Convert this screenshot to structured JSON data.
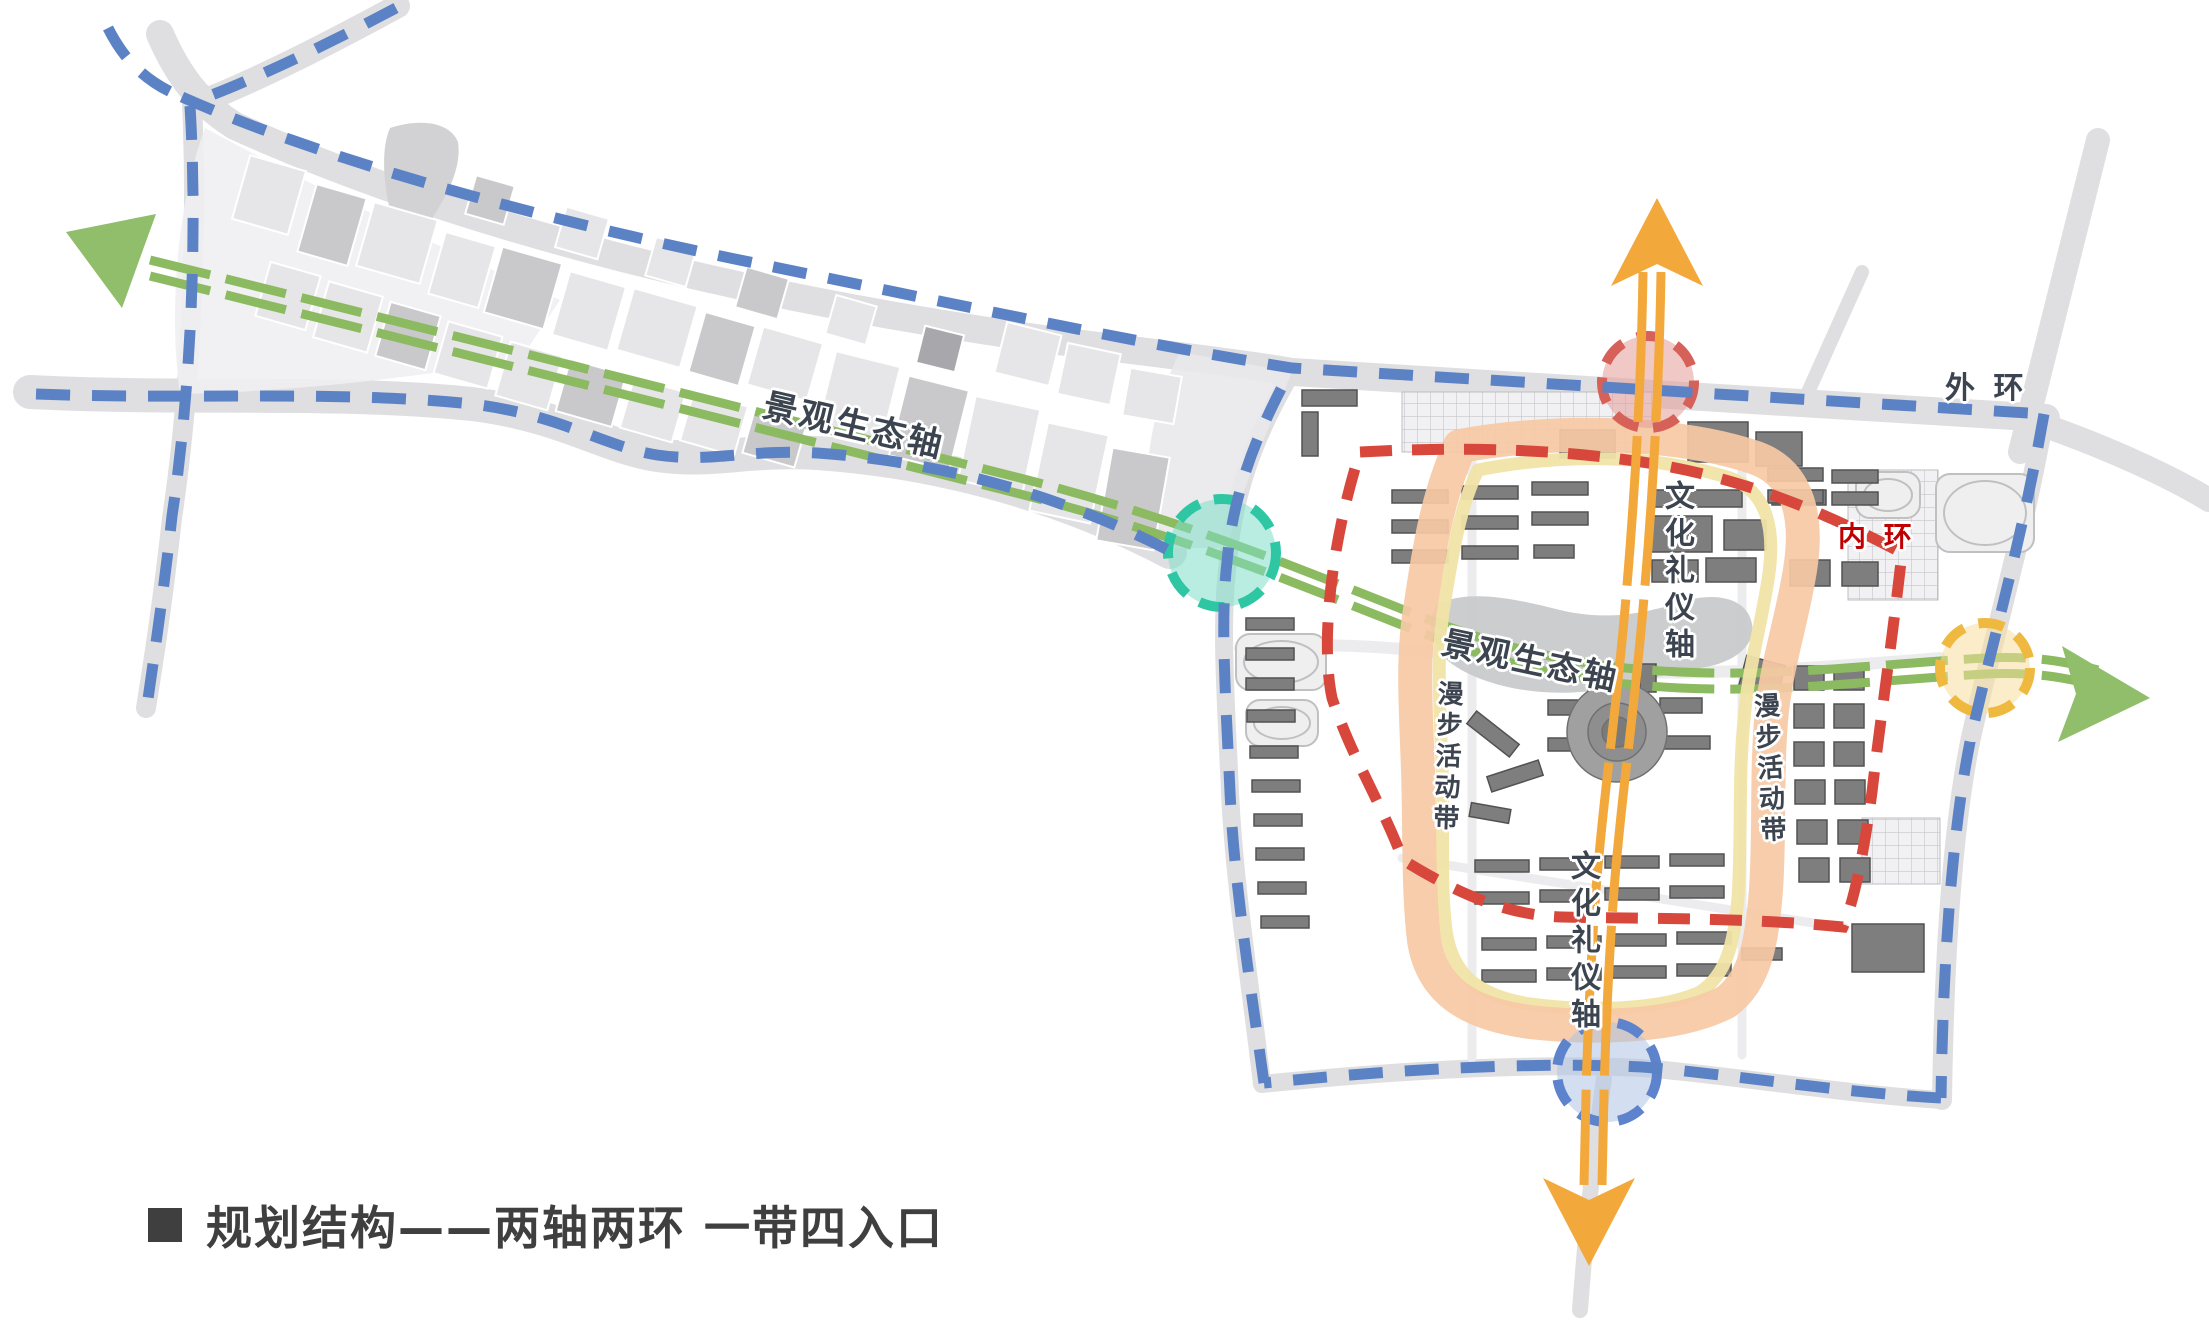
{
  "title": {
    "text": "规划结构——两轴两环  一带四入口"
  },
  "labels": {
    "outer_ring": "外 环",
    "inner_ring": "内 环",
    "eco_axis_west": "景观生态轴",
    "eco_axis_center": "景观生态轴",
    "culture_axis_top": "文化礼仪轴",
    "culture_axis_bottom": "文化礼仪轴",
    "stroll_belt_left": "漫步活动带",
    "stroll_belt_right": "漫步活动带"
  },
  "colors": {
    "road": "#DFDFE1",
    "road_light": "#ECECEE",
    "outer_blue": "#5C82C6",
    "inner_red": "#D7473C",
    "green": "#8BBA60",
    "green_arrow": "#90BE6B",
    "orange": "#F3A83C",
    "peach": "#F6C9A5",
    "yellow_band": "#F1E4A6",
    "teal_ring": "#2FC6A4",
    "teal_fill": "#7FDFC8",
    "red_ring": "#D66158",
    "red_fill": "#E39B97",
    "blue_ring": "#5C83CB",
    "blue_fill": "#AFC4E6",
    "gold_ring": "#EFB93F",
    "gold_fill": "#F7DF9C",
    "building": "#7E7E7E",
    "building_stroke": "#525252",
    "parcel_light": "#E6E6E8",
    "parcel_med": "#C9C9CC",
    "parcel_dark": "#A8A8AC",
    "blob": "#D2D2D4",
    "pond": "#C8CACB",
    "text_dark": "#3C4450",
    "text_red": "#C00000",
    "title_color": "#3F3F3F"
  },
  "map": {
    "roads": [
      {
        "d": "M 160,34 C 178,76 200,104 235,126 C 470,232 760,300 1050,340 C 1180,356 1260,366 1292,372 L 2046,418",
        "w": 28
      },
      {
        "d": "M 398,6 C 335,40 266,76 206,100",
        "w": 24
      },
      {
        "d": "M 2020,452 L 2098,140",
        "w": 24
      },
      {
        "d": "M 2040,424 C 2120,452 2180,482 2209,500",
        "w": 24
      },
      {
        "d": "M 192,102 C 198,240 190,398 172,518 C 163,600 154,658 146,708",
        "w": 20
      },
      {
        "d": "M 30,392 C 190,400 335,390 472,404 C 562,415 602,446 657,455 C 712,463 747,449 817,453 C 962,463 1082,506 1170,552",
        "w": 34
      },
      {
        "d": "M 2044,418 C 2022,542 1992,642 1970,742 C 1952,832 1944,962 1942,1100",
        "w": 20
      },
      {
        "d": "M 1942,1100 C 1842,1094 1722,1074 1642,1068 C 1522,1062 1382,1072 1262,1084",
        "w": 18
      },
      {
        "d": "M 1292,372 C 1264,420 1234,482 1228,562 C 1220,622 1226,702 1230,792 C 1234,882 1250,982 1262,1084",
        "w": 18
      },
      {
        "d": "M 1604,1078 C 1594,1150 1586,1230 1580,1310",
        "w": 16
      },
      {
        "d": "M 1800,410 L 1862,272",
        "w": 14
      },
      {
        "d": "M 1240,648 C 1380,638 1470,658 1560,668 C 1660,678 1800,670 1940,658",
        "w": 12,
        "light": 1
      },
      {
        "d": "M 1472,462 L 1472,1058",
        "w": 9,
        "light": 1
      },
      {
        "d": "M 1742,470 L 1742,1055",
        "w": 9,
        "light": 1
      },
      {
        "d": "M 1402,858 L 1845,928",
        "w": 9,
        "light": 1
      }
    ],
    "blobs": [
      {
        "d": "M 205,128 C 320,190 440,248 560,300 L 520,360 C 400,380 280,392 180,394 C 168,310 178,200 205,128 Z",
        "fill": "#F0F0F2",
        "o": 0.9
      },
      {
        "d": "M 390,128 C 420,118 450,122 458,142 C 462,170 445,198 430,222 C 418,240 398,236 392,218 C 384,190 380,150 390,128 Z",
        "fill": "#D2D2D4",
        "o": 1
      },
      {
        "d": "M 1180,352 L 1292,372 C 1268,430 1240,490 1228,548 L 1150,548 C 1140,480 1150,410 1180,352 Z",
        "fill": "#E9E9EB",
        "o": 0.9
      },
      {
        "d": "M 1438,604 C 1470,588 1520,600 1560,610 C 1610,622 1650,612 1688,600 C 1720,592 1748,600 1752,624 C 1756,648 1730,664 1700,668 C 1660,674 1620,690 1580,692 C 1530,696 1480,684 1452,664 C 1432,650 1424,618 1438,604 Z",
        "fill": "#C8CACB",
        "o": 0.95
      }
    ],
    "parcels": [
      [
        240,
        162,
        58,
        66,
        16,
        0
      ],
      [
        306,
        190,
        52,
        70,
        16,
        1
      ],
      [
        364,
        210,
        66,
        66,
        16,
        0
      ],
      [
        436,
        238,
        52,
        64,
        16,
        0
      ],
      [
        492,
        254,
        62,
        68,
        16,
        1
      ],
      [
        560,
        278,
        58,
        66,
        16,
        0
      ],
      [
        624,
        296,
        66,
        64,
        16,
        0
      ],
      [
        696,
        318,
        52,
        62,
        16,
        1
      ],
      [
        754,
        334,
        62,
        60,
        16,
        0
      ],
      [
        262,
        268,
        52,
        56,
        16,
        0
      ],
      [
        320,
        288,
        56,
        58,
        16,
        0
      ],
      [
        382,
        308,
        52,
        56,
        16,
        1
      ],
      [
        440,
        328,
        56,
        54,
        16,
        0
      ],
      [
        502,
        348,
        54,
        56,
        16,
        0
      ],
      [
        562,
        366,
        58,
        54,
        16,
        1
      ],
      [
        626,
        384,
        54,
        52,
        16,
        0
      ],
      [
        686,
        398,
        56,
        51,
        16,
        0
      ],
      [
        748,
        413,
        54,
        48,
        16,
        1
      ],
      [
        826,
        358,
        66,
        76,
        14,
        0
      ],
      [
        898,
        382,
        62,
        82,
        14,
        1
      ],
      [
        966,
        402,
        66,
        86,
        12,
        0
      ],
      [
        1038,
        428,
        62,
        90,
        12,
        0
      ],
      [
        1104,
        452,
        58,
        94,
        10,
        1
      ],
      [
        1000,
        328,
        56,
        52,
        14,
        0
      ],
      [
        1062,
        348,
        54,
        52,
        12,
        0
      ],
      [
        1126,
        372,
        52,
        48,
        10,
        0
      ],
      [
        470,
        180,
        40,
        40,
        16,
        1
      ],
      [
        560,
        212,
        44,
        42,
        16,
        0
      ],
      [
        650,
        242,
        42,
        40,
        16,
        0
      ],
      [
        740,
        272,
        44,
        42,
        16,
        1
      ],
      [
        830,
        300,
        42,
        40,
        16,
        0
      ],
      [
        920,
        330,
        40,
        38,
        14,
        2
      ]
    ],
    "grids": [
      [
        1402,
        392,
        252,
        60
      ],
      [
        1848,
        470,
        90,
        130
      ],
      [
        1862,
        818,
        78,
        66
      ]
    ],
    "fields": [
      [
        1856,
        472,
        64,
        46
      ],
      [
        1936,
        474,
        98,
        78
      ],
      [
        1236,
        634,
        90,
        56
      ],
      [
        1246,
        700,
        72,
        46
      ]
    ],
    "buildings": [
      [
        1392,
        490,
        56,
        13
      ],
      [
        1392,
        520,
        56,
        13
      ],
      [
        1392,
        550,
        56,
        13
      ],
      [
        1462,
        486,
        56,
        13
      ],
      [
        1462,
        516,
        56,
        13
      ],
      [
        1462,
        546,
        56,
        13
      ],
      [
        1532,
        482,
        56,
        13
      ],
      [
        1532,
        512,
        56,
        13
      ],
      [
        1534,
        545,
        40,
        13
      ],
      [
        1650,
        490,
        92,
        17
      ],
      [
        1650,
        516,
        62,
        36
      ],
      [
        1724,
        520,
        42,
        30
      ],
      [
        1772,
        490,
        54,
        15
      ],
      [
        1652,
        560,
        46,
        22
      ],
      [
        1706,
        558,
        50,
        24
      ],
      [
        1560,
        430,
        55,
        28
      ],
      [
        1688,
        422,
        60,
        40
      ],
      [
        1756,
        432,
        46,
        34
      ],
      [
        1768,
        468,
        55,
        13
      ],
      [
        1768,
        490,
        55,
        13
      ],
      [
        1832,
        470,
        46,
        13
      ],
      [
        1832,
        492,
        46,
        13
      ],
      [
        1302,
        390,
        55,
        16
      ],
      [
        1302,
        412,
        16,
        44
      ],
      [
        1246,
        618,
        48,
        12
      ],
      [
        1246,
        648,
        48,
        12
      ],
      [
        1246,
        678,
        48,
        12
      ],
      [
        1247,
        710,
        48,
        12
      ],
      [
        1250,
        746,
        48,
        12
      ],
      [
        1252,
        780,
        48,
        12
      ],
      [
        1254,
        814,
        48,
        12
      ],
      [
        1256,
        848,
        48,
        12
      ],
      [
        1258,
        882,
        48,
        12
      ],
      [
        1261,
        916,
        48,
        12
      ],
      [
        1466,
        726,
        54,
        16,
        38
      ],
      [
        1488,
        768,
        54,
        16,
        -18
      ],
      [
        1470,
        806,
        40,
        14,
        10
      ],
      [
        1475,
        860,
        54,
        12
      ],
      [
        1475,
        892,
        54,
        12
      ],
      [
        1540,
        858,
        54,
        12
      ],
      [
        1540,
        890,
        54,
        12
      ],
      [
        1605,
        856,
        54,
        12
      ],
      [
        1605,
        888,
        54,
        12
      ],
      [
        1670,
        854,
        54,
        12
      ],
      [
        1670,
        886,
        54,
        12
      ],
      [
        1482,
        938,
        54,
        12
      ],
      [
        1482,
        970,
        54,
        12
      ],
      [
        1547,
        936,
        54,
        12
      ],
      [
        1547,
        968,
        54,
        12
      ],
      [
        1612,
        934,
        54,
        12
      ],
      [
        1612,
        966,
        54,
        12
      ],
      [
        1677,
        932,
        54,
        12
      ],
      [
        1677,
        964,
        54,
        12
      ],
      [
        1742,
        948,
        40,
        12
      ],
      [
        1794,
        666,
        30,
        24
      ],
      [
        1834,
        666,
        30,
        24
      ],
      [
        1794,
        704,
        30,
        24
      ],
      [
        1834,
        704,
        30,
        24
      ],
      [
        1794,
        742,
        30,
        24
      ],
      [
        1834,
        742,
        30,
        24
      ],
      [
        1795,
        780,
        30,
        24
      ],
      [
        1835,
        780,
        30,
        24
      ],
      [
        1797,
        820,
        30,
        24
      ],
      [
        1838,
        820,
        30,
        24
      ],
      [
        1799,
        858,
        30,
        24
      ],
      [
        1840,
        858,
        30,
        24
      ],
      [
        1852,
        924,
        72,
        48
      ],
      [
        1548,
        700,
        38,
        15
      ],
      [
        1548,
        738,
        44,
        13
      ],
      [
        1660,
        698,
        42,
        15
      ],
      [
        1664,
        736,
        46,
        13
      ],
      [
        1588,
        666,
        16,
        28
      ],
      [
        1640,
        664,
        16,
        28
      ],
      [
        1742,
        660,
        40,
        32,
        15
      ],
      [
        1790,
        560,
        40,
        26
      ],
      [
        1842,
        562,
        36,
        24
      ]
    ],
    "plaza": {
      "cx": 1617,
      "cy": 732,
      "r": [
        50,
        29,
        15
      ]
    },
    "green_axis": {
      "d": "M 150,268 C 400,330 750,418 1020,486 C 1200,532 1330,590 1430,628 C 1530,666 1600,676 1680,680 C 1780,685 1880,672 1985,666 C 2030,664 2060,668 2098,678",
      "dash": "62 16",
      "w": 9,
      "offset": 8,
      "arrows": [
        "66,232 156,214 140,258 122,308",
        "2150,698 2062,646 2076,694 2058,742"
      ]
    },
    "yellow_band": {
      "d": "M 1478,470 C 1570,452 1660,456 1730,478 C 1768,492 1776,530 1768,580 C 1760,630 1748,670 1744,720 C 1738,780 1742,840 1738,898 C 1734,945 1726,975 1700,992 C 1660,1010 1590,1012 1530,1004 C 1480,996 1452,976 1446,930 C 1440,884 1444,826 1442,766 C 1440,706 1436,656 1444,606 C 1452,556 1460,506 1478,470 Z",
      "w": 13
    },
    "peach_band": {
      "d": "M 1460,446 C 1560,428 1680,432 1756,458 C 1800,474 1808,520 1800,570 C 1792,620 1778,660 1772,710 C 1766,770 1770,830 1766,890 C 1762,940 1756,980 1726,1002 C 1680,1026 1600,1030 1530,1022 C 1470,1014 1432,992 1424,940 C 1418,890 1420,830 1418,770 C 1416,710 1412,660 1420,610 C 1428,556 1436,500 1460,446 Z",
      "w": 34
    },
    "entrances": [
      {
        "name": "north-entrance",
        "ring": "red_ring",
        "fill": "red_fill",
        "cx": 1648,
        "cy": 382,
        "r": 46
      },
      {
        "name": "south-entrance",
        "ring": "blue_ring",
        "fill": "blue_fill",
        "cx": 1607,
        "cy": 1072,
        "r": 50
      },
      {
        "name": "west-entrance",
        "ring": "teal_ring",
        "fill": "teal_fill",
        "cx": 1222,
        "cy": 553,
        "r": 54
      },
      {
        "name": "east-entrance",
        "ring": "gold_ring",
        "fill": "gold_fill",
        "cx": 1985,
        "cy": 668,
        "r": 45
      }
    ],
    "outer_ring": [
      "M 108,28 C 126,64 150,84 182,97",
      "M 396,8 C 332,42 262,76 204,98",
      "M 182,97 C 320,158 520,214 730,258 C 960,305 1130,342 1292,368 L 2044,414",
      "M 190,106 C 198,240 190,396 172,516 C 163,598 154,656 147,706",
      "M 36,394 C 190,400 335,390 472,404 C 562,415 602,446 657,455 C 712,463 747,449 817,453 C 962,463 1082,506 1168,550",
      "M 2044,414 C 2022,540 1992,642 1970,742 C 1952,832 1943,962 1941,1098",
      "M 1941,1098 C 1842,1093 1722,1073 1642,1067 C 1522,1061 1382,1071 1264,1083",
      "M 1264,1083 C 1250,982 1234,882 1230,792 C 1226,702 1220,622 1227,562 C 1234,482 1264,420 1292,368"
    ],
    "inner_ring": {
      "d": "M 1360,452 C 1470,446 1562,450 1642,462 C 1742,477 1824,512 1902,553 C 1892,642 1880,722 1872,792 C 1864,852 1854,902 1843,927 C 1742,917 1642,919 1562,917 C 1502,915 1452,890 1403,860 C 1380,800 1352,758 1332,698 C 1320,640 1332,540 1360,452 Z"
    },
    "orange_axis": {
      "d": "M 1652,272 C 1650,400 1642,520 1633,620 C 1624,720 1612,800 1605,890 C 1599,970 1595,1060 1593,1185",
      "dash": "150 14",
      "w": 9,
      "offset": 9,
      "arrows": [
        "1657,198 1703,286 1657,264 1611,286",
        "1589,1266 1635,1178 1589,1200 1543,1178"
      ]
    }
  }
}
